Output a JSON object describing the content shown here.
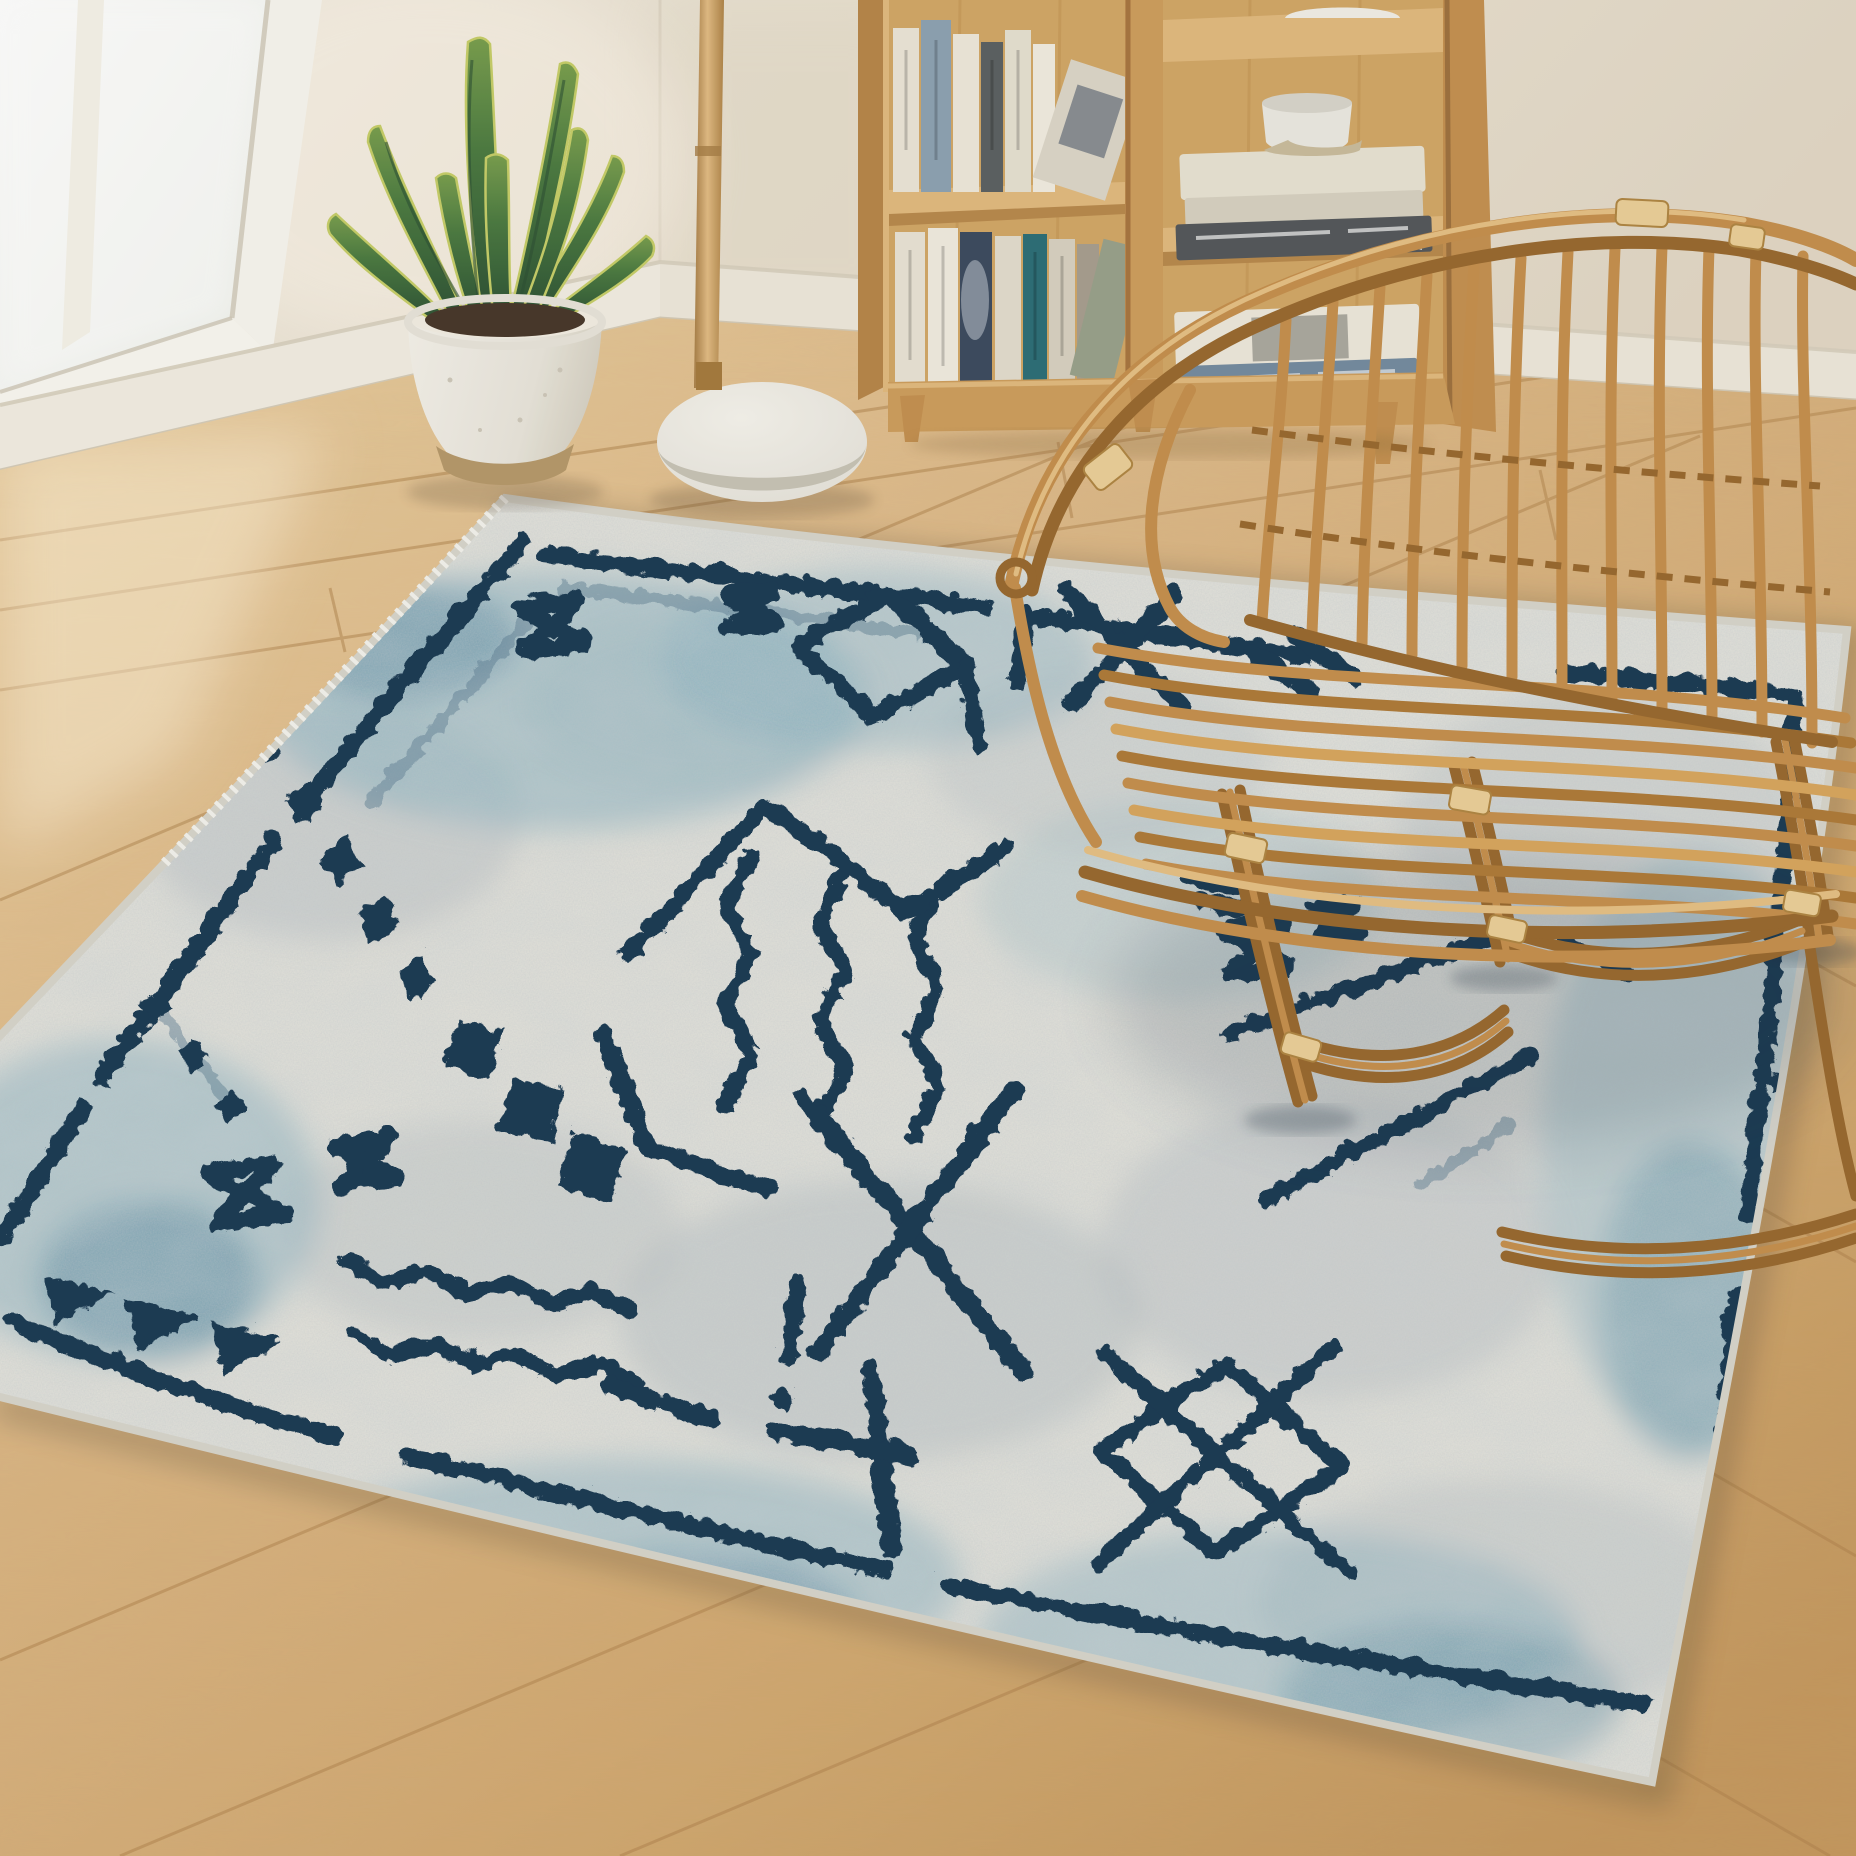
{
  "scene": {
    "setting": "sunlit living room corner with a distressed Moroccan-style area rug, rattan armchair, wooden bookshelf, snake plant, floor lamp and light oak floor",
    "wall": {
      "left": "#f1eadd",
      "right": "#e8decd",
      "corner_shade": "#ddd2c0"
    },
    "baseboard": {
      "face": "#f3eee3",
      "shadow": "#d8d0bf"
    },
    "window": {
      "frame": "#f8f6f0",
      "glass": "#fcfdfa",
      "mullion": "#f6f3ea",
      "sill_edge": "#e6e1d4"
    },
    "floor": {
      "base": "#ddb886",
      "bright": "#eed7ab",
      "dark": "#c79a5f",
      "seam": "#b2854f"
    },
    "lamp": {
      "pole": "#caa066",
      "pole_dark": "#a97f48",
      "base": "#f0eee7",
      "base_rim": "#c9c4b7"
    },
    "plant": {
      "pot": "#f1eee7",
      "pot_shadow": "#d9d4c8",
      "pot_base": "#b79a6c",
      "soil": "#49392b",
      "leaf_dark": "#33593a",
      "leaf_mid": "#5d8a4a",
      "leaf_edge": "#c8cf6a"
    },
    "bookshelf": {
      "wood": "#cf9f5e",
      "wood_light": "#e2bb80",
      "wood_dark": "#a87741",
      "interior": "#d3a868",
      "left_top_colors": [
        "#ece6d8",
        "#8fa3b4",
        "#efe9db",
        "#5d6263",
        "#e7e1d2",
        "#f2ede1",
        "#ddd7c9"
      ],
      "left_bottom_colors": [
        "#eae4d6",
        "#f1ece0",
        "#3e4c60",
        "#e3ddcf",
        "#2e6f78",
        "#d9d2c2",
        "#a89f90",
        "#9aa28c"
      ],
      "right_top_stack": [
        "#e9e3d4",
        "#d8d2c2",
        "#55595c"
      ],
      "right_bottom_stack": [
        "#eee9dc",
        "#768ca1",
        "#f0ebe0"
      ],
      "bowl": "#eceae2",
      "bowl_base": "#cbbd9e",
      "vase": "#f2efe8"
    },
    "chair": {
      "rattan_mid": "#c6914f",
      "rattan_dark": "#9a6a30",
      "rattan_light": "#e7c186",
      "lashing": "#ecd09a"
    },
    "rug": {
      "style": "distressed Berber / Moroccan geometric",
      "base": "#eae8e0",
      "mottle_gray": "#a9b2ba",
      "accent_teal": "#7fb0c1",
      "accent_teal_deep": "#4e86a0",
      "motif_navy": "#1e3c55",
      "motif_faded": "#5d7d93",
      "binding": "#d8d6cd",
      "motifs": [
        "border-lines",
        "hourglass-bowties",
        "diamond-chain",
        "solid-triangles",
        "zigzag-waves",
        "vertical-zigzags",
        "chevron-peak",
        "corner-bracket",
        "large-x-cross",
        "diamond-with-x",
        "diagonal-dashes",
        "dash-dot-marks"
      ]
    }
  }
}
